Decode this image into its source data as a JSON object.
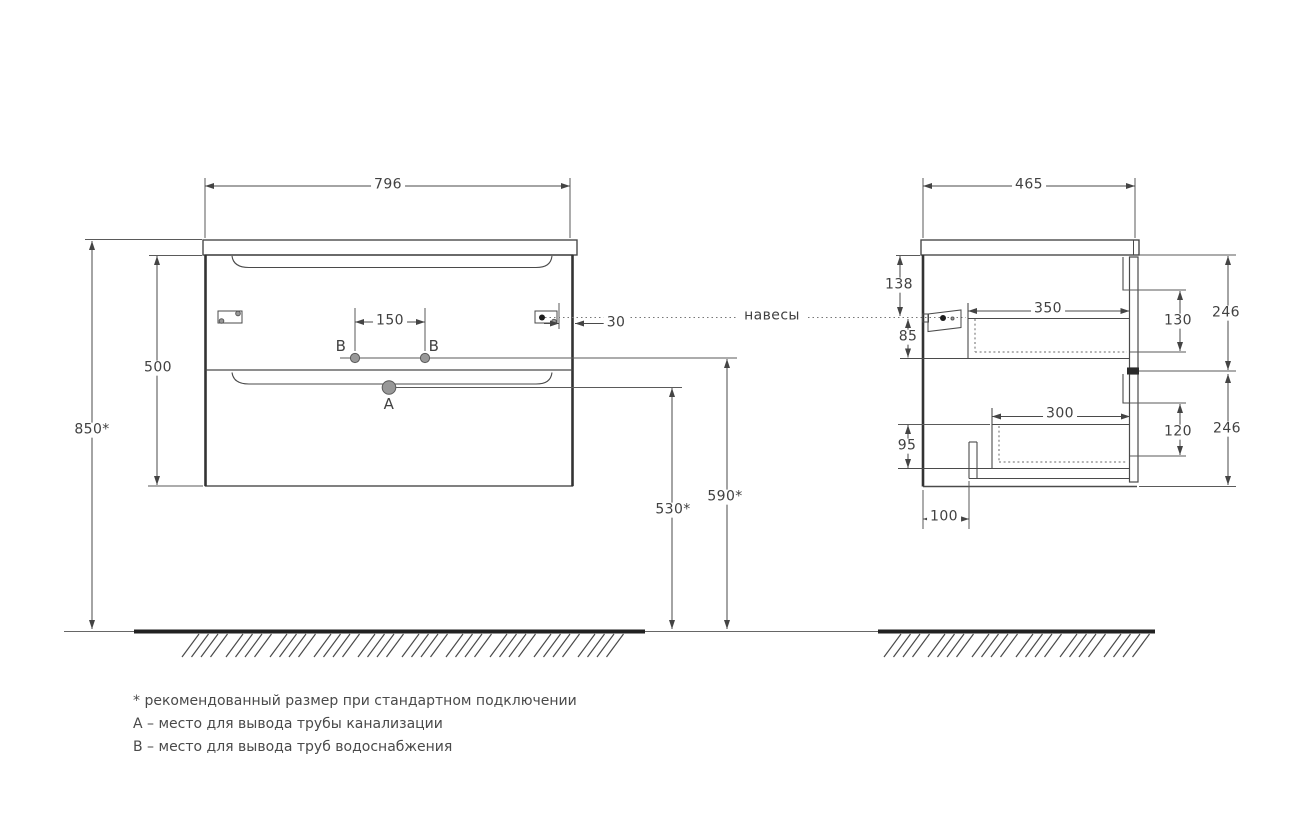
{
  "views": {
    "front": {
      "width": "796",
      "height": "500",
      "mount_height": "850*",
      "holes_spacing": "150",
      "hanger_offset": "30",
      "supply_height": "590*",
      "drain_height": "530*",
      "hole_a": "A",
      "hole_b_left": "B",
      "hole_b_right": "B"
    },
    "side": {
      "depth": "465",
      "top_offset": "138",
      "hanger_drop": "85",
      "upper_drawer_depth": "350",
      "upper_drawer_inner_height": "130",
      "upper_front_height": "246",
      "lower_drawer_depth": "300",
      "lower_drawer_inner_height": "120",
      "lower_front_height": "246",
      "bottom_offset": "95",
      "back_offset": "100"
    }
  },
  "callouts": {
    "hangers": "навесы"
  },
  "notes": [
    "* рекомендованный размер при стандартном подключении",
    "А – место для вывода трубы канализации",
    "В – место для вывода труб водоснабжения"
  ],
  "colors": {
    "line": "#4a4a4a",
    "floor": "#222222",
    "hatch": "#9e9e9e",
    "text": "#414141",
    "hole_fill": "#989898",
    "dot_fill": "#1c1c1c"
  }
}
